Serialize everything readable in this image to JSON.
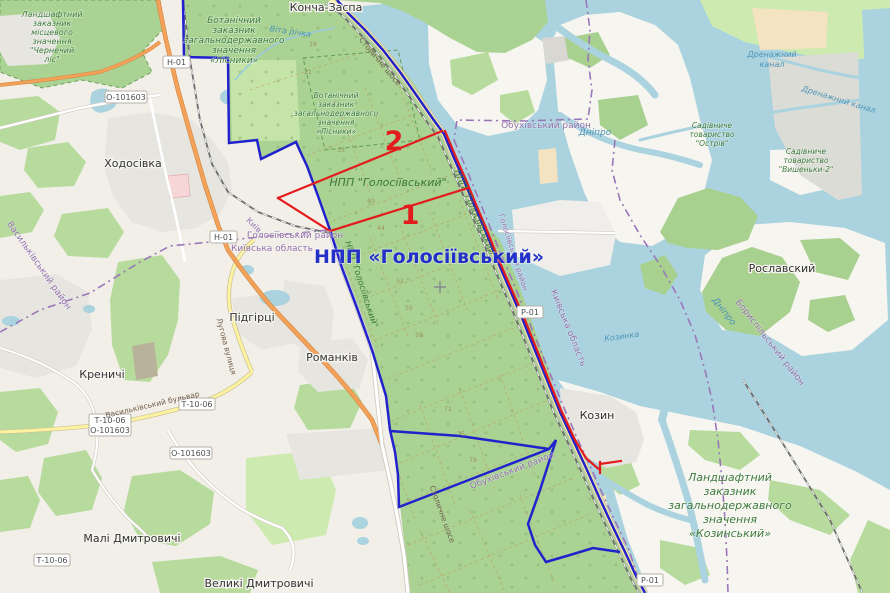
{
  "colors": {
    "land": "#f2efe9",
    "water": "#aad3df",
    "park_green": "#a9d293",
    "forest_green": "#b7db9c",
    "boundary_blue": "#2222cc",
    "annotation_red": "#e31b1c",
    "admin_purple": "#9a77b8",
    "trunk_orange": "#f4a259",
    "road_yellow": "#fcf2a0"
  },
  "park": {
    "name_blue": "НПП «Голосіївський»",
    "name_green": "НПП \"Голосіївський\"",
    "area_1": "1",
    "area_2": "2",
    "compartments": [
      "19",
      "21",
      "33",
      "40",
      "44",
      "52",
      "55",
      "59",
      "71",
      "75",
      "79"
    ]
  },
  "towns": {
    "koncha_zaspa": "Конча-Заспа",
    "khodosivka": "Ходосівка",
    "pidhirtsi": "Підгірці",
    "romankiv": "Романків",
    "krenychi": "Креничі",
    "mali_dmytrovychi": "Малі Дмитровичі",
    "velyki_dmytrovychi": "Великі Дмитровичі",
    "kozyn": "Козин",
    "roslavskyi": "Рославский"
  },
  "reserves": {
    "chernechyi": [
      "Ландшафтний",
      "заказник",
      "місцевого",
      "значення",
      "\"Чернечий",
      "ліс\""
    ],
    "lisnyky": [
      "Ботанічний",
      "заказник",
      "загальнодержавного",
      "значення",
      "«Лісники»"
    ],
    "kozynskyi": [
      "Ландшафтний",
      "заказник",
      "загальнодержавного",
      "значення",
      "«Козинський»"
    ],
    "sadivnyche_ostriv": [
      "Садівниче",
      "товариство",
      "\"Острів\""
    ],
    "sadivnyche_vyshenky": [
      "Садівниче",
      "товариство",
      "\"Вишеньки-2\""
    ]
  },
  "water": {
    "dnipro": "Дніпро",
    "vita": "Віта річка",
    "kozynka": "Козинка",
    "drainage_line1": "Дренажний",
    "drainage_line2": "канал",
    "drainage": "Дренажний канал"
  },
  "admin": {
    "kyiv": "Київ",
    "kyiv_oblast": "Київська область",
    "holosiivskyi_raion": "Голосіївський район",
    "obukhivskyi_raion": "Обухівський район",
    "boryspilskyi_raion": "Бориспільський район",
    "vasylkivskyi_raion": "Васильківський район"
  },
  "roads": {
    "badges": {
      "h01": "Н-01",
      "o101603": "О-101603",
      "p01": "Р-01",
      "t1006": "Т-10-06"
    },
    "names": {
      "stolychne": "Столичне шосе",
      "vasylkivskyi_blvd": "Васильківський бульвар",
      "luhova": "Лугова вулиця"
    }
  }
}
